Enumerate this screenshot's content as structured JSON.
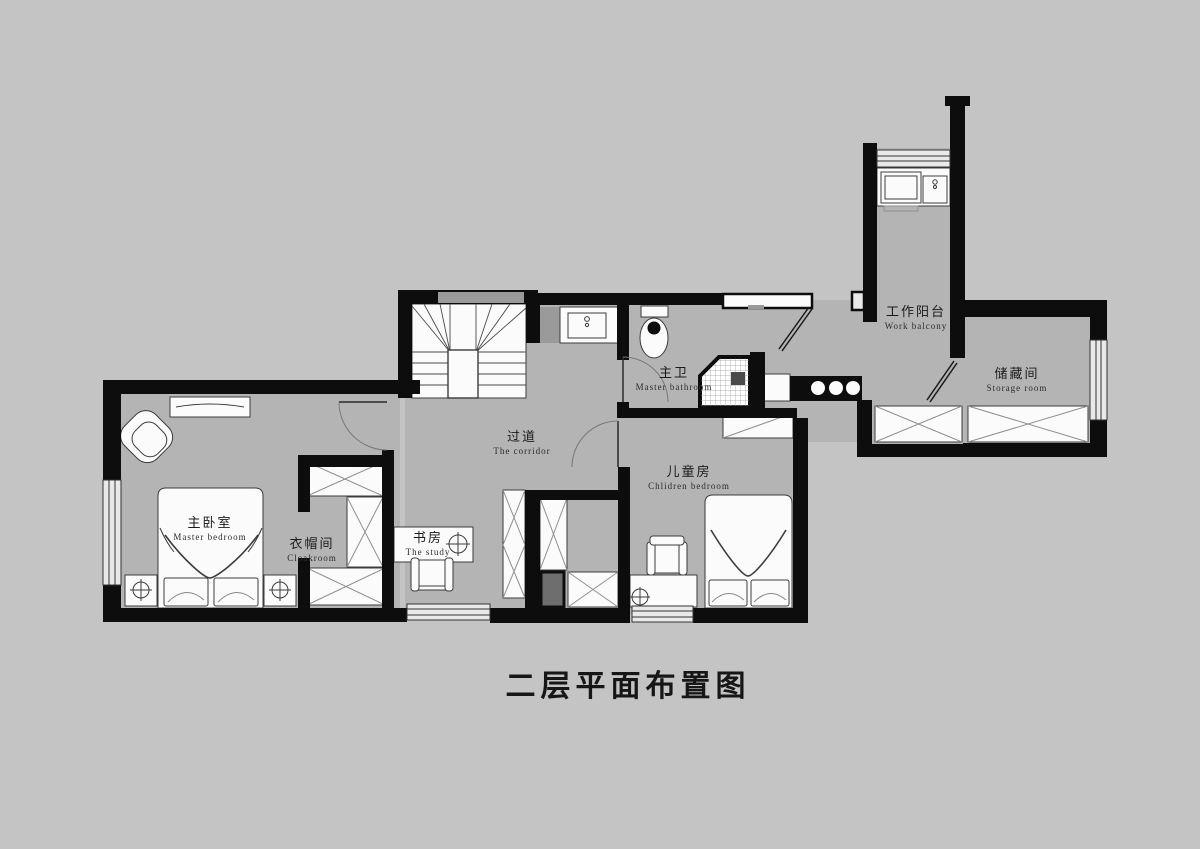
{
  "title": "二层平面布置图",
  "rooms": [
    {
      "name_cn": "主卧室",
      "name_en": "Master bedroom"
    },
    {
      "name_cn": "衣帽间",
      "name_en": "Cloakroom"
    },
    {
      "name_cn": "书房",
      "name_en": "The study"
    },
    {
      "name_cn": "过道",
      "name_en": "The corridor"
    },
    {
      "name_cn": "主卫",
      "name_en": "Master bathroom"
    },
    {
      "name_cn": "儿童房",
      "name_en": "Chlidren bedroom"
    },
    {
      "name_cn": "工作阳台",
      "name_en": "Work balcony"
    },
    {
      "name_cn": "储藏间",
      "name_en": "Storage room"
    }
  ],
  "colors": {
    "background": "#c4c4c4",
    "room_floor": "#b4b4b4",
    "wall": "#0d0d0d",
    "furniture_fill": "#fbfbfb",
    "furniture_stroke": "#3c3c3c"
  }
}
